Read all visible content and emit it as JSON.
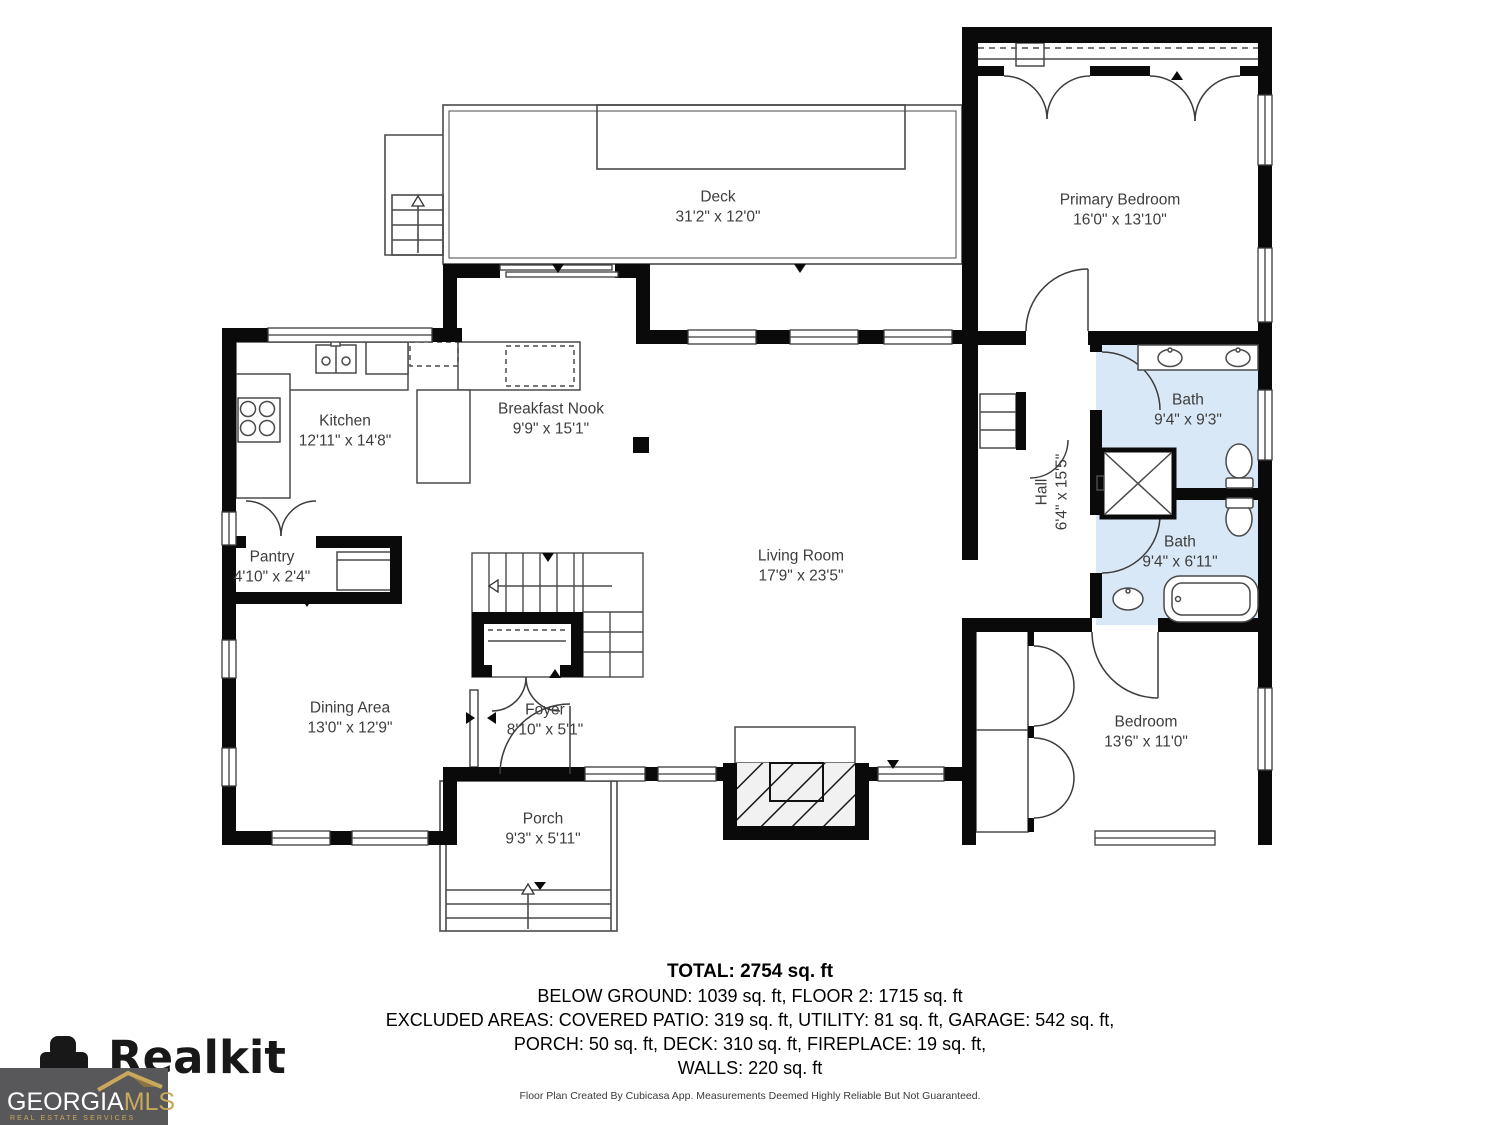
{
  "rooms": [
    {
      "name": "Deck",
      "dims": "31'2\" x 12'0\""
    },
    {
      "name": "Primary Bedroom",
      "dims": "16'0\" x 13'10\""
    },
    {
      "name": "Kitchen",
      "dims": "12'11\" x 14'8\""
    },
    {
      "name": "Breakfast Nook",
      "dims": "9'9\" x 15'1\""
    },
    {
      "name": "Bath",
      "dims": "9'4\" x 9'3\""
    },
    {
      "name": "Hall",
      "dims": "6'4\" x 15'5\""
    },
    {
      "name": "Bath",
      "dims": "9'4\" x 6'11\""
    },
    {
      "name": "Living Room",
      "dims": "17'9\" x 23'5\""
    },
    {
      "name": "Pantry",
      "dims": "4'10\" x 2'4\""
    },
    {
      "name": "Dining Area",
      "dims": "13'0\" x 12'9\""
    },
    {
      "name": "Foyer",
      "dims": "8'10\" x 5'1\""
    },
    {
      "name": "Porch",
      "dims": "9'3\" x 5'11\""
    },
    {
      "name": "Bedroom",
      "dims": "13'6\" x 11'0\""
    }
  ],
  "summary": {
    "total": "TOTAL: 2754 sq. ft",
    "line1": "BELOW GROUND: 1039 sq. ft, FLOOR 2: 1715 sq. ft",
    "line2": "EXCLUDED AREAS: COVERED PATIO: 319 sq. ft, UTILITY: 81 sq. ft, GARAGE: 542 sq. ft,",
    "line3": "PORCH: 50 sq. ft, DECK: 310 sq. ft, FIREPLACE: 19 sq. ft,",
    "line4": "WALLS: 220 sq. ft",
    "disclaimer": "Floor Plan Created By Cubicasa App. Measurements Deemed Highly Reliable But Not Guaranteed."
  },
  "branding": {
    "realkit": "Realkit",
    "georgia": "GEORGIA",
    "mls": "MLS",
    "services": "REAL ESTATE SERVICES"
  },
  "colors": {
    "bath_fill": "#d9e8f6",
    "wall": "#0a0a0a",
    "mls_gold": "#c9a85c",
    "mls_bg": "#58585a"
  }
}
